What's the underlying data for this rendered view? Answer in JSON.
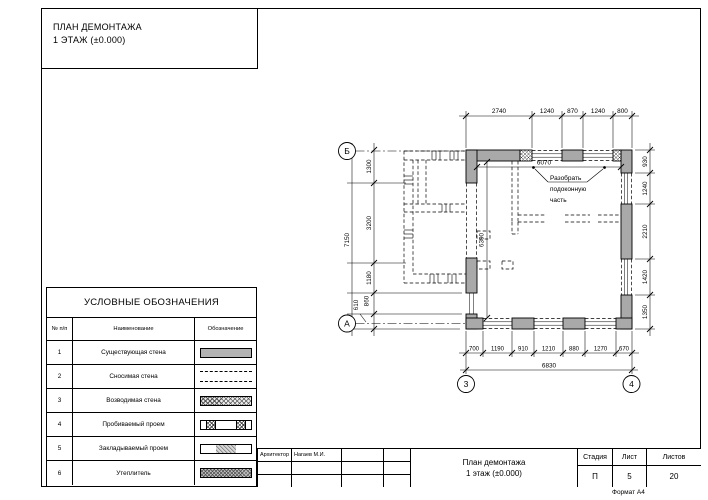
{
  "drawing": {
    "title_line1": "ПЛАН ДЕМОНТАЖА",
    "title_line2": "1 ЭТАЖ (±0.000)"
  },
  "legend": {
    "title": "УСЛОВНЫЕ ОБОЗНАЧЕНИЯ",
    "columns": {
      "num": "№ п/п",
      "name": "Наименование",
      "symbol": "Обозначение"
    },
    "rows": [
      {
        "num": "1",
        "name": "Существующая стена",
        "symbol": "existing-wall-swatch"
      },
      {
        "num": "2",
        "name": "Сносимая стена",
        "symbol": "demolished-wall-swatch"
      },
      {
        "num": "3",
        "name": "Возводимая стена",
        "symbol": "new-wall-swatch"
      },
      {
        "num": "4",
        "name": "Пробиваемый проем",
        "symbol": "punched-opening-swatch"
      },
      {
        "num": "5",
        "name": "Закладываемый проем",
        "symbol": "infilled-opening-swatch"
      },
      {
        "num": "6",
        "name": "Утеплитель",
        "symbol": "insulation-swatch"
      }
    ]
  },
  "plan": {
    "dims_top": [
      "2740",
      "1240",
      "870",
      "1240",
      "800"
    ],
    "dims_left": [
      "1300",
      "3200",
      "1180",
      "860",
      "610"
    ],
    "dim_left_total": "7150",
    "dims_right": [
      "930",
      "1240",
      "2210",
      "1420",
      "1350"
    ],
    "dims_bottom": [
      "700",
      "1190",
      "910",
      "1210",
      "880",
      "1270",
      "670"
    ],
    "dim_bottom_total": "6830",
    "dim_inner_width": "6070",
    "dim_inner_height": "6390",
    "note": {
      "line1": "Разобрать",
      "line2": "подоконную",
      "line3": "часть"
    },
    "axes": {
      "row_top": "Б",
      "row_bottom": "А",
      "col_left": "3",
      "col_right": "4"
    }
  },
  "title_block": {
    "role_label": "Архитектор",
    "role_name": "Нагаев М.И.",
    "doc_title_line1": "План демонтажа",
    "doc_title_line2": "1 этаж (±0.000)",
    "stage_label": "Стадия",
    "stage_value": "П",
    "sheet_label": "Лист",
    "sheet_value": "5",
    "sheets_label": "Листов",
    "sheets_value": "20",
    "format_label": "Формат А4"
  }
}
